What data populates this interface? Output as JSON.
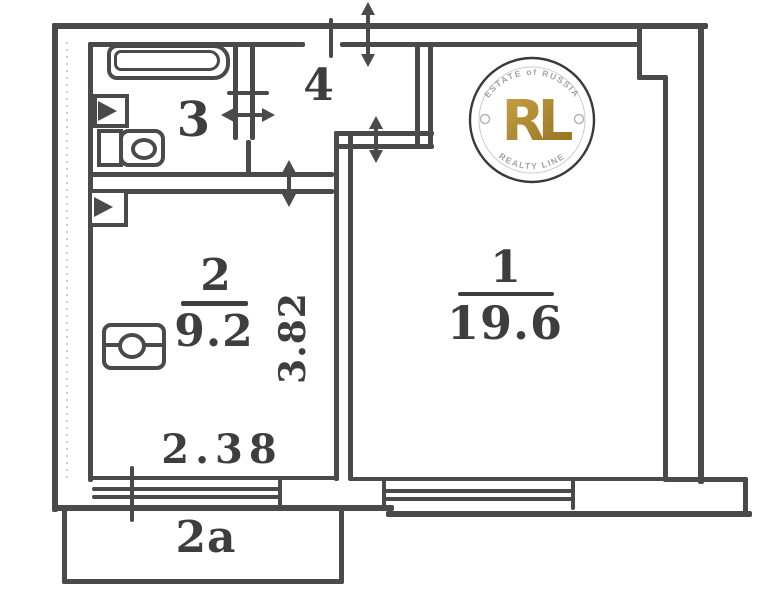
{
  "rooms": [
    {
      "number": "1",
      "area": "19.6"
    },
    {
      "number": "2",
      "area": "9.2"
    },
    {
      "number": "3"
    },
    {
      "number": "4"
    }
  ],
  "dimensions": {
    "bottom_width": "2.38",
    "side_depth": "3.82"
  },
  "balcony": {
    "label": "2a"
  },
  "watermark": {
    "monogram": "RL",
    "arc_top": "ESTATE of RUSSIA",
    "arc_bottom": "REALTY LINE"
  },
  "colors": {
    "wall": "#4a4a4a",
    "label": "#3e3e3e",
    "arc_text": "#a3a3a3",
    "gold_light": "#c9a446",
    "gold_dark": "#8f6e1e"
  }
}
